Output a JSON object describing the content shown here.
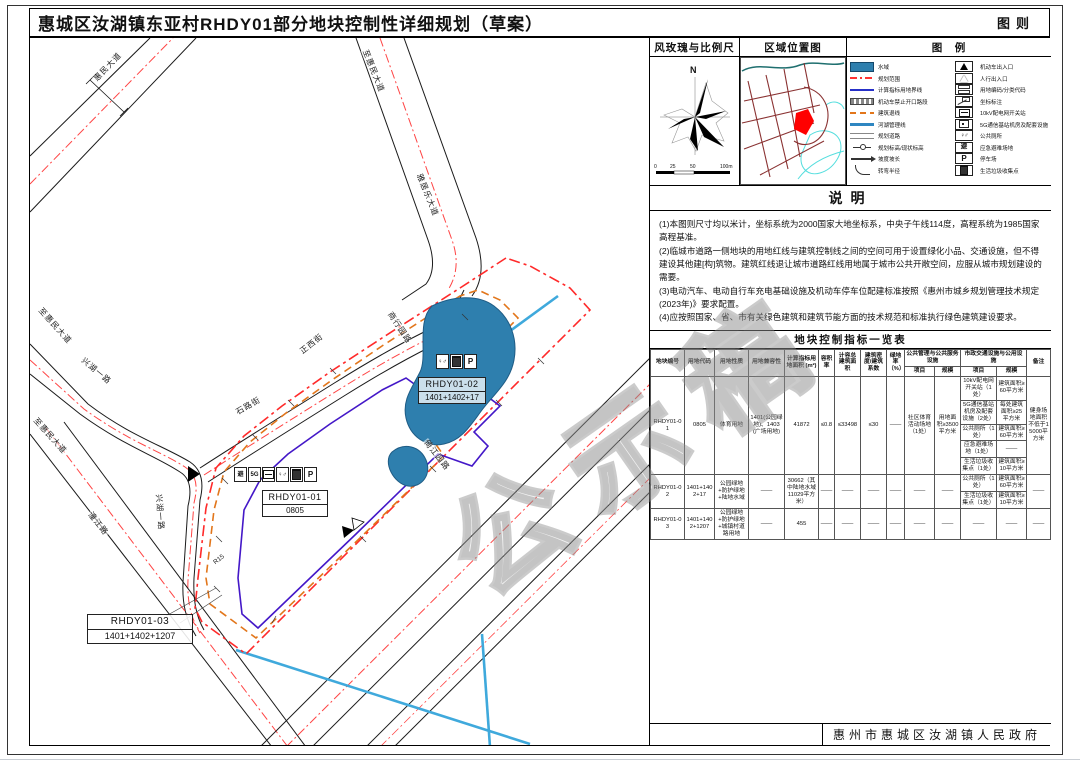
{
  "title": {
    "main": "惠城区汝湖镇东亚村RHDY01部分地块控制性详细规划（草案）",
    "right": "图则"
  },
  "colors": {
    "water": "#2E7FAE",
    "plan_boundary_red": "#FF3333",
    "setback_orange": "#E2761B",
    "indicator_purple": "#4418C8",
    "river_line_blue": "#2E86C1",
    "location_highlight": "#FF0000",
    "location_road": "#8A3232"
  },
  "windrose": {
    "title": "风玫瑰与比例尺",
    "north": "N",
    "scale_ticks": [
      "0",
      "25",
      "50",
      "100m"
    ]
  },
  "location": {
    "title": "区域位置图"
  },
  "legend": {
    "title": "图　例",
    "left": [
      {
        "label": "水域"
      },
      {
        "label": "规划范围"
      },
      {
        "label": "计算指标用地界线"
      },
      {
        "label": "机动车禁止开口路段"
      },
      {
        "label": "建筑退线"
      },
      {
        "label": "河湖管理线"
      },
      {
        "label": "规划道路"
      },
      {
        "label": "规划标高/现状标高"
      },
      {
        "label": "坡度坡长"
      },
      {
        "label": "转弯半径"
      }
    ],
    "right": [
      {
        "label": "机动车出入口"
      },
      {
        "label": "人行出入口"
      },
      {
        "label": "用地编码/分类代码"
      },
      {
        "label": "坐标标注"
      },
      {
        "label": "10kV配电网开关站"
      },
      {
        "label": "5G通信基站机房及配套设施"
      },
      {
        "label": "公共厕所"
      },
      {
        "label": "应急避难场地"
      },
      {
        "label": "停车场"
      },
      {
        "label": "生活垃圾收集点"
      }
    ]
  },
  "notes": {
    "title": "说明",
    "lines": [
      "(1)本图则尺寸均以米计，坐标系统为2000国家大地坐标系，中央子午线114度，高程系统为1985国家高程基准。",
      "(2)临城市道路一侧地块的用地红线与建筑控制线之间的空间可用于设置绿化小品、交通设施，但不得建设其他建[构]筑物。建筑红线退让城市道路红线用地属于城市公共开敞空间，应服从城市规划建设的需要。",
      "(3)电动汽车、电动自行车充电基础设施及机动车停车位配建标准按照《惠州市城乡规划管理技术规定(2023年)》要求配置。",
      "(4)应按照国家、省、市有关绿色建筑和建筑节能方面的技术规范和标准执行绿色建筑建设要求。"
    ]
  },
  "table": {
    "title": "地块控制指标一览表",
    "headers": {
      "id": "地块编号",
      "code": "用地代码",
      "use": "用地性质",
      "compat": "用地兼容性",
      "area": "计算指标用地面积 (m²)",
      "far": "容积率",
      "gfa": "计容总建筑面积",
      "density": "建筑密度/建筑系数",
      "green": "绿地率（%）",
      "public_group": "公共管理与公共服务设施",
      "muni_group": "市政交通设施与公用设施",
      "item": "项目",
      "scale": "规模",
      "remark": "备注"
    },
    "row1": {
      "id": "RHDY01-01",
      "code": "0805",
      "use": "体育用地",
      "compat": "1401(公园绿地)、1403(广场用地)",
      "area": "41872",
      "far": "≤0.8",
      "gfa": "≤33498",
      "density": "≤30",
      "green": "——",
      "public_item": "社区体育活动场地（1处）",
      "public_scale": "用地面积≥3500平方米",
      "muni": [
        {
          "item": "10kV配电网开关站（1处）",
          "scale": "建筑面积≥60平方米"
        },
        {
          "item": "5G通信基站机房及配套设施（2处）",
          "scale": "每处建筑面积≥25平方米"
        },
        {
          "item": "公共厕所（1处）",
          "scale": "建筑面积≥60平方米"
        },
        {
          "item": "应急避难场地（1处）",
          "scale": "——"
        },
        {
          "item": "生活垃圾收集点（1处）",
          "scale": "建筑面积≥10平方米"
        }
      ],
      "remark": "健身场地面积不低于15000平方米"
    },
    "row2": {
      "id": "RHDY01-02",
      "code": "1401+1402+17",
      "use": "公园绿地+防护绿地+陆地水域",
      "compat": "——",
      "area": "30662（其中陆地水域11029平方米）",
      "far": "——",
      "gfa": "——",
      "density": "——",
      "green": "——",
      "public_item": "——",
      "public_scale": "——",
      "muni": [
        {
          "item": "公共厕所（1处）",
          "scale": "建筑面积≥60平方米"
        },
        {
          "item": "生活垃圾收集点（1处）",
          "scale": "建筑面积≥10平方米"
        }
      ],
      "remark": "——"
    },
    "row3": {
      "id": "RHDY01-03",
      "code": "1401+1402+1207",
      "use": "公园绿地+防护绿地+城镇村道路用地",
      "compat": "——",
      "area": "455",
      "far": "——",
      "gfa": "——",
      "density": "——",
      "green": "——",
      "public_item": "——",
      "public_scale": "——",
      "muni_item": "——",
      "muni_scale": "——",
      "remark": "——"
    }
  },
  "footer": {
    "agency": "惠州市惠城区汝湖镇人民政府"
  },
  "map": {
    "watermark": "公示稿",
    "road_labels": [
      {
        "text": "惠民大道"
      },
      {
        "text": "至惠民大道"
      },
      {
        "text": "雅居乐大道"
      },
      {
        "text": "至惠民大道"
      },
      {
        "text": "兴湖一路"
      },
      {
        "text": "兴湖一路"
      },
      {
        "text": "至惠民大道"
      },
      {
        "text": "潼江路"
      },
      {
        "text": "石路街"
      },
      {
        "text": "正西街"
      },
      {
        "text": "商行园路"
      },
      {
        "text": "倚江园路"
      },
      {
        "text": "R15"
      }
    ],
    "parcels": {
      "p1": {
        "id": "RHDY01-01",
        "code": "0805",
        "icons": [
          "避",
          "5G",
          "switch",
          "toilet",
          "bin",
          "P"
        ]
      },
      "p2": {
        "id": "RHDY01-02",
        "code": "1401+1402+17",
        "icons": [
          "toilet",
          "bin",
          "P"
        ]
      },
      "p3": {
        "id": "RHDY01-03",
        "code": "1401+1402+1207"
      }
    },
    "icon_glyphs": {
      "shelter": "避",
      "five_g": "5G",
      "toilet": "♀♂",
      "parking": "P"
    }
  }
}
